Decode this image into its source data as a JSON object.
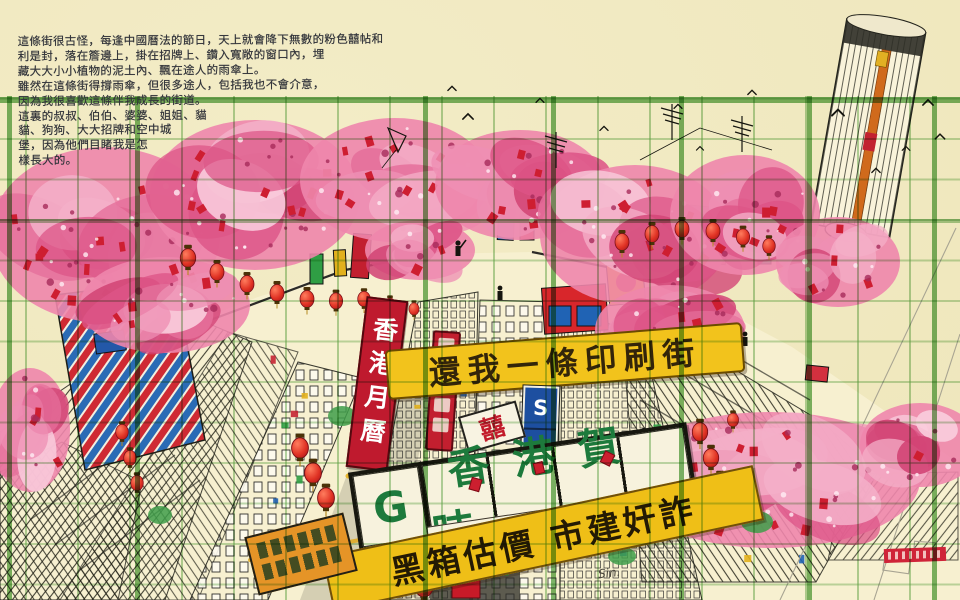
{
  "artwork": {
    "handwriting_lines": [
      "這條街很古怪，每逢中國曆法的節日，天上就會降下無數的粉色囍帖和",
      "利是封，落在簷邊上，掛在招牌上、鑽入寬敞的窗口內，埋",
      "藏大大小小植物的泥土內、飄在途人的雨傘上。",
      "雖然在這條街得撐雨傘，但很多途人，包括我也不會介意，",
      "因為我很喜歡這條伴我成長的街道。",
      "這裏的叔叔、伯伯、婆婆、姐姐、貓",
      "貓、狗狗、大大招牌和空中城",
      "堡，因為他們目睹我是怎",
      "樣長大的。"
    ],
    "signs": {
      "protest_banner": "還我一條印刷街",
      "calendar_banner_vertical": "香港月曆",
      "greeting_card_logo": "G",
      "greeting_card_sign": "香港賀咭",
      "calendar_shop_sign": "安碧月曆",
      "urban_renewal_banner": "黑箱估價 市建奸詐",
      "vertical_letter_sign": [
        "S",
        "A"
      ],
      "double_happiness_sign": "囍"
    },
    "signature_scribble": "Sin."
  },
  "colors": {
    "paper": "#efe8bf",
    "grid_green": "#6fae5c",
    "blossom_pink": "#e8739c",
    "banner_yellow": "#f2c31c",
    "sign_red": "#bf1a2e",
    "sign_blue": "#1d4fa0",
    "ink": "#23231c",
    "sign_green_text": "#1d7a3c"
  }
}
